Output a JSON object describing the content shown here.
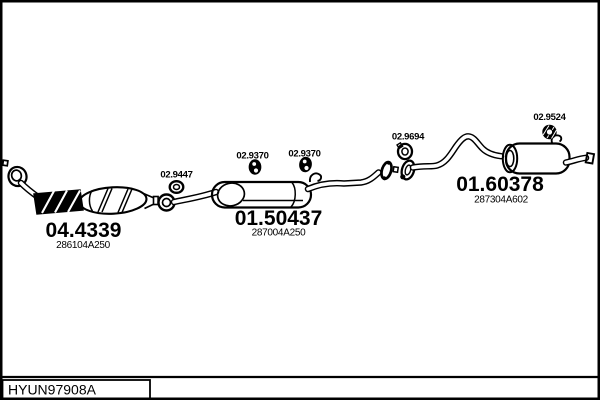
{
  "colors": {
    "ink": "#000000",
    "paper": "#ffffff"
  },
  "footer": {
    "catalog_code": "HYUN97908A"
  },
  "parts": {
    "front_pipe_cat": {
      "code": "04.4339",
      "ref": "286104A250"
    },
    "center_muffler": {
      "code": "01.50437",
      "ref": "287004A250"
    },
    "rear_muffler": {
      "code": "01.60378",
      "ref": "287304A602"
    },
    "gasket_front": {
      "code": "02.9447"
    },
    "hanger_center_1": {
      "code": "02.9370"
    },
    "hanger_center_2": {
      "code": "02.9370"
    },
    "hanger_rear_pipe": {
      "code": "02.9694"
    },
    "hanger_tail": {
      "code": "02.9524"
    }
  }
}
